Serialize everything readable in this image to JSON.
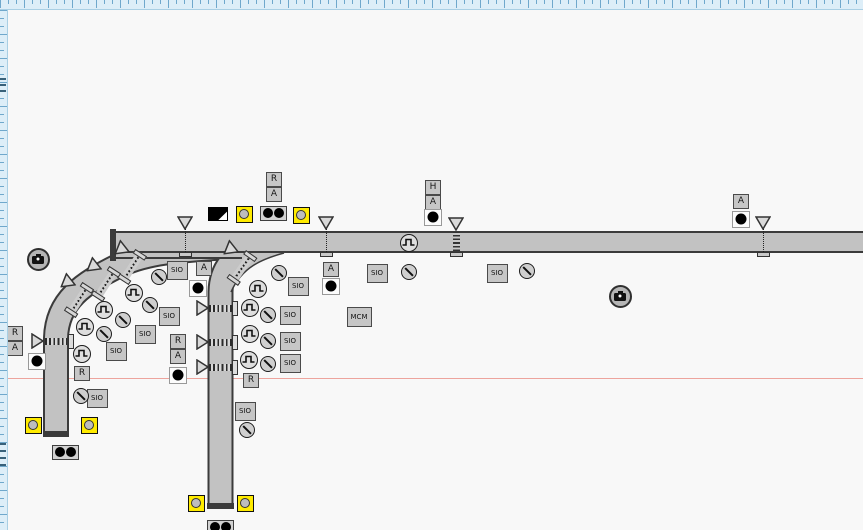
{
  "canvas": {
    "width": 863,
    "height": 530
  },
  "labels": {
    "sio": "SIO",
    "mcm": "MCM"
  },
  "colors": {
    "bg": "#f8f8f8",
    "road": "#c2c2c2",
    "edge": "#3b3b3b",
    "box-fill": "#c6c6c6",
    "box-border": "#4a4a4a",
    "yellow": "#ffeb00",
    "ruler-bg": "#ddeef8",
    "ruler-tick": "#6fa8cc",
    "ruler-border": "#a9cfe4",
    "guide": "#eda49d"
  },
  "rulers": {
    "top_height": 10,
    "left_width": 8,
    "minor_step": 8,
    "major_step": 24,
    "left_marks_y": [
      78,
      84,
      90,
      443,
      450,
      457,
      464
    ]
  },
  "guide_line": {
    "y": 378
  },
  "roads": {
    "main": {
      "x1": 111,
      "x2": 863,
      "top": 231,
      "bottom": 253
    },
    "left_ext": {
      "x1": 111,
      "x2": 242,
      "top": 231,
      "bottom": 259
    },
    "left_cap": {
      "x": 110,
      "y": 229,
      "w": 6,
      "h": 32
    },
    "branch_left": {
      "path": "M 243,246 C 185,250 148,251 118,266 C 84,283 57,300 56,338 L 56,433",
      "width": 22,
      "cap": {
        "x": 43,
        "y": 431,
        "w": 26,
        "h": 6
      }
    },
    "branch_mid": {
      "path": "M 252,248 C 234,256 221,268 220.5,292 L 220.5,505",
      "width": 22,
      "cap": {
        "x": 207,
        "y": 503,
        "w": 27,
        "h": 6
      }
    },
    "mid_flare": {
      "fill_path": "M 284,253 C 262,259 242,267 231,292 L 231,253 Z",
      "edge_path": "M 284,253 C 262,259 242,267 231,292"
    }
  },
  "detectors": {
    "signal_heads": [
      {
        "x": 185,
        "tri_top": 216,
        "style": "dotted"
      },
      {
        "x": 326,
        "tri_top": 216,
        "style": "dotted"
      },
      {
        "x": 456,
        "tri_top": 217,
        "style": "band"
      },
      {
        "x": 763,
        "tri_top": 216,
        "style": "dotted"
      }
    ],
    "mid_road_rows": [
      {
        "cy": 308,
        "tri_x": 202
      },
      {
        "cy": 342,
        "tri_x": 202
      },
      {
        "cy": 367,
        "tri_x": 202
      }
    ],
    "mid_band_x1": 209,
    "mid_band_x2": 232,
    "mid_bracket_x": 231.5,
    "left_road_row": {
      "cy": 341,
      "tri_x": 37,
      "x1": 45,
      "x2": 67,
      "bracket_x": 67.5
    },
    "diagonal_bands": [
      {
        "cx": 132,
        "cy": 267,
        "rot": 33,
        "tri_x": 120,
        "tri_y": 250,
        "tri_rot": 52
      },
      {
        "cx": 106,
        "cy": 284,
        "rot": 33,
        "tri_x": 92,
        "tri_y": 267,
        "tri_rot": 52
      },
      {
        "cx": 79,
        "cy": 300,
        "rot": 33,
        "tri_x": 66,
        "tri_y": 283,
        "tri_rot": 52
      },
      {
        "cx": 242,
        "cy": 268,
        "rot": 35,
        "tri_x": 229,
        "tri_y": 250,
        "tri_rot": 52
      }
    ]
  },
  "symbols": {
    "letter_boxes": [
      {
        "label": "R",
        "x": 274,
        "y": 179
      },
      {
        "label": "A",
        "x": 274,
        "y": 194
      },
      {
        "label": "H",
        "x": 433,
        "y": 187
      },
      {
        "label": "A",
        "x": 433,
        "y": 202
      },
      {
        "label": "A",
        "x": 741,
        "y": 201
      },
      {
        "label": "A",
        "x": 331,
        "y": 269
      },
      {
        "label": "A",
        "x": 204,
        "y": 268
      },
      {
        "label": "R",
        "x": 178,
        "y": 341
      },
      {
        "label": "A",
        "x": 178,
        "y": 356
      },
      {
        "label": "R",
        "x": 15,
        "y": 333
      },
      {
        "label": "A",
        "x": 15,
        "y": 348
      },
      {
        "label": "R",
        "x": 82,
        "y": 373
      },
      {
        "label": "R",
        "x": 251,
        "y": 380
      }
    ],
    "dot_boxes": [
      {
        "x": 433,
        "y": 217
      },
      {
        "x": 741,
        "y": 219
      },
      {
        "x": 331,
        "y": 286
      },
      {
        "x": 198,
        "y": 288
      },
      {
        "x": 178,
        "y": 375
      },
      {
        "x": 37,
        "y": 361
      }
    ],
    "double_dot_boxes": [
      {
        "x": 273,
        "y": 213
      },
      {
        "x": 65,
        "y": 452
      },
      {
        "x": 220,
        "y": 527
      }
    ],
    "yellow_markers": [
      {
        "x": 244,
        "y": 214
      },
      {
        "x": 301,
        "y": 215
      },
      {
        "x": 33,
        "y": 425
      },
      {
        "x": 89,
        "y": 425
      },
      {
        "x": 196,
        "y": 503
      },
      {
        "x": 245,
        "y": 503
      }
    ],
    "cameras": [
      {
        "x": 38,
        "y": 259
      },
      {
        "x": 620,
        "y": 296
      }
    ],
    "flag": {
      "x": 218,
      "y": 214
    },
    "sio_boxes": [
      {
        "x": 377,
        "y": 273
      },
      {
        "x": 497,
        "y": 273
      },
      {
        "x": 298,
        "y": 286
      },
      {
        "x": 290,
        "y": 315
      },
      {
        "x": 290,
        "y": 341
      },
      {
        "x": 290,
        "y": 363
      },
      {
        "x": 177,
        "y": 270
      },
      {
        "x": 169,
        "y": 316
      },
      {
        "x": 145,
        "y": 334
      },
      {
        "x": 116,
        "y": 351
      },
      {
        "x": 97,
        "y": 398
      },
      {
        "x": 245,
        "y": 411
      }
    ],
    "mcm_box": {
      "x": 359,
      "y": 317
    },
    "pulse_circles": [
      {
        "x": 409,
        "y": 243
      },
      {
        "x": 258,
        "y": 289
      },
      {
        "x": 250,
        "y": 308
      },
      {
        "x": 250,
        "y": 334
      },
      {
        "x": 249,
        "y": 360
      },
      {
        "x": 134,
        "y": 293
      },
      {
        "x": 104,
        "y": 310
      },
      {
        "x": 85,
        "y": 327
      },
      {
        "x": 82,
        "y": 354
      }
    ],
    "slash_circles": [
      {
        "x": 409,
        "y": 272
      },
      {
        "x": 527,
        "y": 271
      },
      {
        "x": 279,
        "y": 273
      },
      {
        "x": 268,
        "y": 315
      },
      {
        "x": 268,
        "y": 341
      },
      {
        "x": 268,
        "y": 364
      },
      {
        "x": 159,
        "y": 277
      },
      {
        "x": 150,
        "y": 305
      },
      {
        "x": 123,
        "y": 320
      },
      {
        "x": 104,
        "y": 334
      },
      {
        "x": 81,
        "y": 396
      },
      {
        "x": 247,
        "y": 430
      }
    ]
  }
}
